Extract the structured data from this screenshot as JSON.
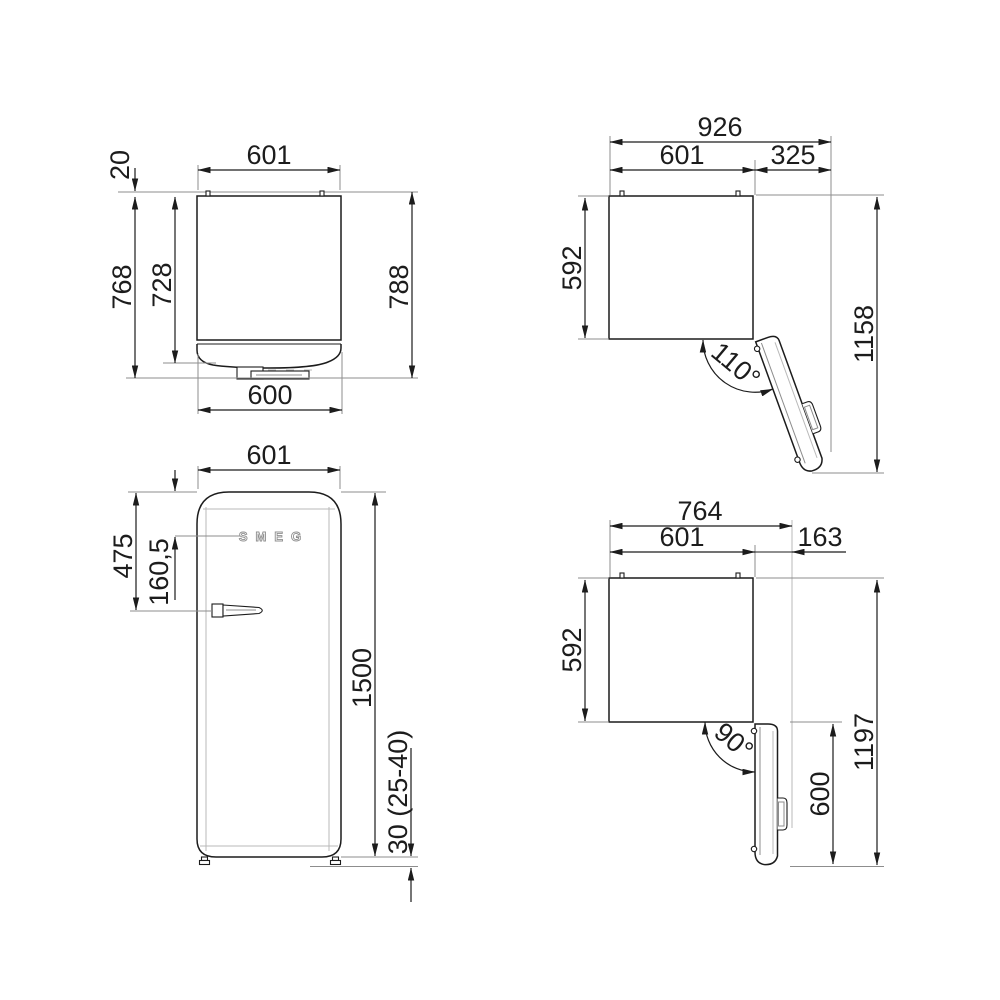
{
  "meta": {
    "description": "Refrigerator installation dimension drawing, four orthographic views, measurements in mm"
  },
  "views": {
    "top_closed": {
      "dims": {
        "width_top": "601",
        "wall_gap": "20",
        "depth_body": "728",
        "depth_with_handle": "768",
        "depth_total": "788",
        "width_door": "600"
      }
    },
    "top_open_110": {
      "dims": {
        "width_total": "926",
        "width_body": "601",
        "door_projection": "325",
        "depth_body": "592",
        "depth_door_open": "1158",
        "opening_angle": "110°"
      }
    },
    "front": {
      "logo": "SMEG",
      "dims": {
        "width": "601",
        "handle_from_top": "475",
        "logo_from_top": "160,5",
        "height": "1500",
        "feet_height": "30 (25-40)"
      }
    },
    "top_open_90": {
      "dims": {
        "width_total": "764",
        "width_body": "601",
        "door_projection": "163",
        "depth_body": "592",
        "depth_door_open": "1197",
        "door_depth": "600",
        "opening_angle": "90°"
      }
    }
  },
  "colors": {
    "line": "#1c1c1c",
    "reference": "#8d8d8d",
    "background": "#ffffff"
  }
}
